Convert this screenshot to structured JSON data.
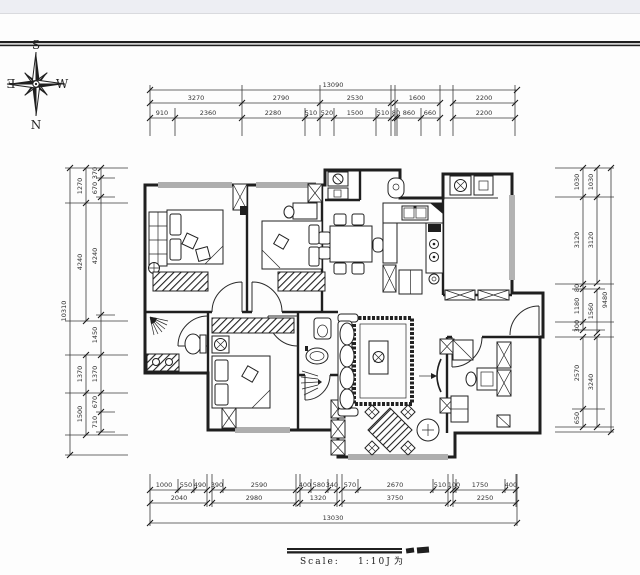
{
  "colors": {
    "ink": "#1f1f1f",
    "top_band": "#edeef3"
  },
  "compass": {
    "north": "N",
    "south": "S",
    "east": "E",
    "west": "W"
  },
  "dims": {
    "top": {
      "total": "13090",
      "row2": [
        "3270",
        "2790",
        "2530",
        "1600",
        "2200"
      ],
      "row3": [
        "910",
        "2360",
        "2280",
        "510",
        "520",
        "1500",
        "510",
        "80",
        "860",
        "660",
        "2200"
      ]
    },
    "left": {
      "total": "10310",
      "mid": [
        "1270",
        "4240",
        "1370",
        "1500"
      ],
      "inner": [
        "370",
        "670",
        "4240",
        "1450",
        "1370",
        "670",
        "710"
      ]
    },
    "right": {
      "total": "9480",
      "mid": [
        "1030",
        "3120",
        "1560",
        "3240"
      ],
      "inner": [
        "1030",
        "3120",
        "80",
        "1180",
        "300",
        "2570",
        "650"
      ]
    },
    "bottom": {
      "total": "13030",
      "row1": [
        "1000",
        "550",
        "490",
        "390",
        "2590",
        "400",
        "580",
        "340",
        "570",
        "2670",
        "510",
        "100",
        "1750",
        "400"
      ],
      "row2": [
        "2040",
        "2980",
        "1320",
        "3750",
        "2250"
      ]
    }
  },
  "footer": {
    "scale_label": "Scale:",
    "scale_value": "1:10Ј",
    "scale_suffix": "为"
  }
}
